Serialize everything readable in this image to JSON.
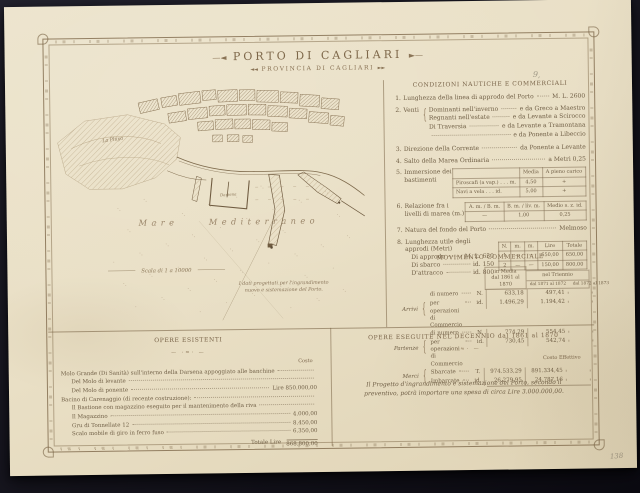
{
  "glyphs": {
    "brace": "{",
    "close_brace": "}"
  },
  "annotations": {
    "top_right": "9,",
    "bottom_right": "138"
  },
  "title": {
    "main": "PORTO DI CAGLIARI",
    "sub": "PROVINCIA DI CAGLIARI",
    "flourish_left": "—◄",
    "flourish_right": "►—",
    "sub_flourish_left": "◄◄",
    "sub_flourish_right": "►►"
  },
  "map": {
    "sea_label": "Mare Mediterraneo",
    "terrain_label": "La Playa",
    "darsena_label": "Darsena",
    "scale_label": "Scala di 1 a 10000",
    "note_line1": "I dati progettati per l'ingrandimento",
    "note_line2": "nuovo e sistemazione del Porto."
  },
  "conditions": {
    "heading": "CONDIZIONI NAUTICHE E COMMERCIALI",
    "item1": {
      "n": "1.",
      "label": "Lunghezza della linea di approdo del Porto",
      "value": "M. L. 2600"
    },
    "item2": {
      "n": "2.",
      "label": "Venti",
      "rows": [
        {
          "k": "Dominanti nell'inverno",
          "v": "e da Greco a Maestro"
        },
        {
          "k": "Regnanti nell'estate",
          "v": "e da Levante a Scirocco"
        },
        {
          "k": "Di Traversia",
          "v": "e da Levante a Tramontana"
        },
        {
          "k": "",
          "v": "e da Ponente a Libeccio"
        }
      ]
    },
    "item3": {
      "n": "3.",
      "label": "Direzione della Corrente",
      "value": "da Ponente a Levante"
    },
    "item4": {
      "n": "4.",
      "label": "Salto della Marea Ordinaria",
      "value": "a Metri 0,25"
    },
    "item5": {
      "n": "5.",
      "label": "Immersione dei bastimenti",
      "table": {
        "headers": [
          "",
          "Media",
          "A pieno carico"
        ],
        "rows": [
          [
            "Piroscafi (a vap.)  .  .  .  m.",
            "4,50",
            "+"
          ],
          [
            "Navi a vela  .  .  .  id.",
            "5,00",
            "+"
          ]
        ]
      }
    },
    "item6": {
      "n": "6.",
      "label": "Relazione fra i livelli di marea (m.)",
      "table": {
        "headers": [
          "A. m. / B. m.",
          "B. m. / liv. m.",
          "Medio s. z. id."
        ],
        "rows": [
          [
            "—",
            "1,00",
            "0,25"
          ]
        ]
      }
    },
    "item7": {
      "n": "7.",
      "label": "Natura del fondo del Porto",
      "value": "Melmoso"
    },
    "item8": {
      "n": "8.",
      "label": "Lunghezza utile degli approdi (Metri)",
      "rows": [
        {
          "k": "Di approdo",
          "v": "M. L. 650"
        },
        {
          "k": "Di sbarco",
          "v": "id. 150"
        },
        {
          "k": "D'attracco",
          "v": "id. 800"
        }
      ],
      "table": {
        "headers": [
          "N.",
          "m.",
          "m.",
          "Lire",
          "Totale"
        ],
        "rows": [
          [
            "1",
            "—",
            "—",
            "650,00",
            "650,00"
          ],
          [
            "2",
            "—",
            "—",
            "150,00",
            "800,00"
          ]
        ]
      }
    }
  },
  "movimento": {
    "heading": "MOVIMENTO COMMERCIALE",
    "col1_header_line1": "in Media",
    "col1_header_line2": "dal 1861 al 1870",
    "col2_group": "nel Triennio",
    "col2_sub1": "dal 1871 al 1872",
    "col2_sub2": "dal 1872 al 1873",
    "groups": [
      {
        "name": "Arrivi",
        "rows": [
          {
            "label": "di numero",
            "unit": "N.",
            "v1": "633,18",
            "v2": "497,41",
            "v3": ""
          },
          {
            "label": "per operazioni di Commercio",
            "unit": "id.",
            "v1": "1.496,29",
            "v2": "1.194,42",
            "v3": ""
          }
        ]
      },
      {
        "name": "Partenze",
        "rows": [
          {
            "label": "di numero",
            "unit": "N.",
            "v1": "774,29",
            "v2": "554,45",
            "v3": ""
          },
          {
            "label": "per operazioni di Commercio",
            "unit": "id.",
            "v1": "730,45",
            "v2": "542,74",
            "v3": ""
          }
        ]
      },
      {
        "name": "Merci",
        "rows": [
          {
            "label": "Sbarcate",
            "unit": "T.",
            "v1": "974.533,29",
            "v2": "891.334,45",
            "v3": ""
          },
          {
            "label": "Imbarcate",
            "unit": "id.",
            "v1": "26.279,95",
            "v2": "24.787,16",
            "v3": ""
          }
        ]
      }
    ]
  },
  "opere_esistenti": {
    "heading": "OPERE ESISTENTI",
    "ornament": "— ·≈· —",
    "costo_header": "Costo",
    "rows": [
      {
        "label": "Molo Grande (Di Sanità) sull'interno della Darsena appoggiato alle banchine",
        "value": ""
      },
      {
        "label": "      Del Molo di levante",
        "value": ""
      },
      {
        "label": "      Del Molo di ponente",
        "value": "Lire   850.000,00"
      },
      {
        "label": "Bacino di Carenaggio (di recente costruzione):",
        "value": ""
      },
      {
        "label": "      Il Bastione con magazzino eseguito per il mantenimento della riva",
        "value": ""
      },
      {
        "label": "      Il Magazzino",
        "value": "4.000,00"
      },
      {
        "label": "      Gru di Tonnellate 12",
        "value": "8.450,00"
      },
      {
        "label": "      Scalo mobile di giro in ferro fuso",
        "value": "6.350,00"
      }
    ],
    "total_label": "Totale Lire",
    "total_value": "868.800,00"
  },
  "opere_eseguite": {
    "heading": "OPERE ESEGUITE NEL DECENNIO dal 1861 al 1870",
    "ornament": "— ·≈· —",
    "costo_header": "Costo Effettivo",
    "paragraph": "Il Progetto d'ingrandimento e sistemazione del Porto, secondo il preventivo, potrà importare una spesa di circa Lire 3.000.000,00."
  }
}
